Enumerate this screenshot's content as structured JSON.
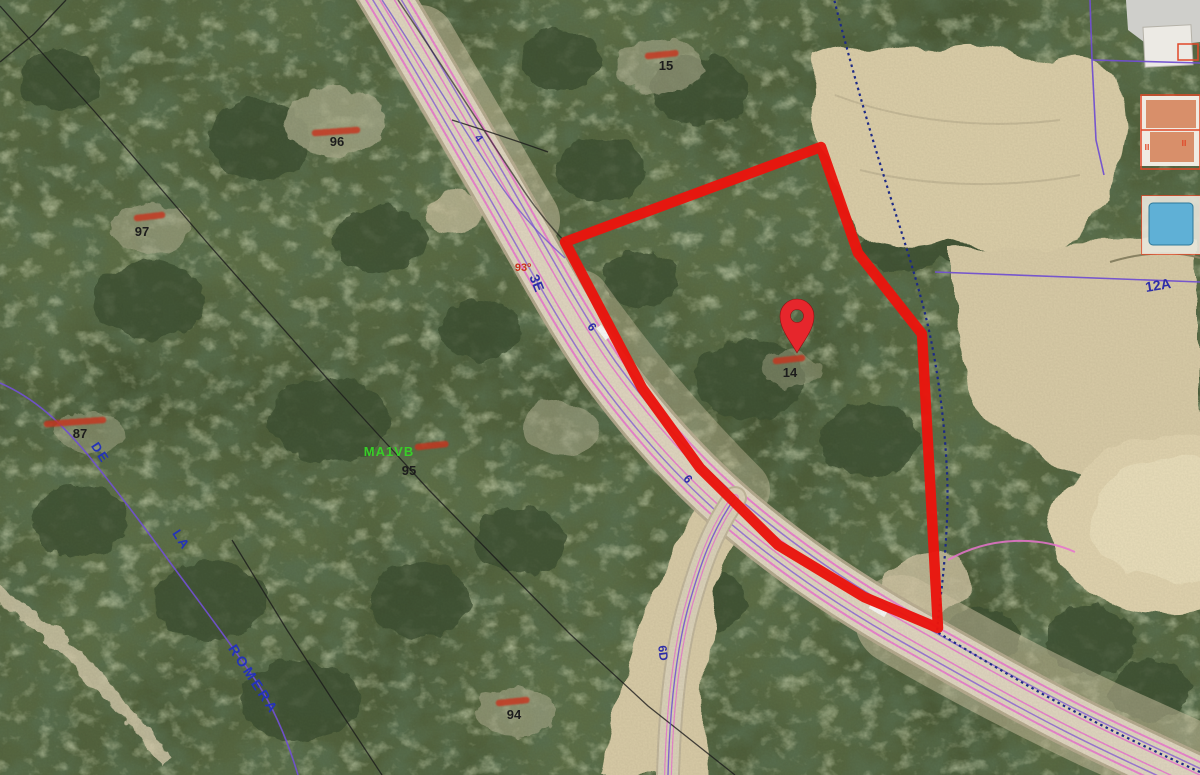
{
  "app": {
    "view_type": "aerial-cadastral-map"
  },
  "map": {
    "parcel_numbers": {
      "p96": "96",
      "p97": "97",
      "p95": "95",
      "p94": "94",
      "p15": "15",
      "p14": "14",
      "p87": "87"
    },
    "road_numbers": {
      "n4": "4",
      "n3e": "3E",
      "n6a": "6",
      "n6b": "6",
      "n6d": "6D",
      "n12a": "12A"
    },
    "red_survey_number": "93º",
    "street_name_parts": {
      "part1": "DE",
      "part2": "LA",
      "part3": "ROMERA"
    },
    "land_code_green": "MA1VB",
    "building_floor_marks": {
      "m1": "II",
      "m2": "II"
    },
    "colors": {
      "selection_outline": "#e9150d",
      "pin": "#e6262c",
      "cadastral_pink": "#e673cc",
      "cadastral_purple": "#7150cf",
      "cadastral_navy_dotted": "#1d2a85",
      "street_label_blue": "#2433b8",
      "road_number_blue": "#2d2da8",
      "parcel_label_black": "#1c1c1c",
      "land_code_green_color": "#38cf28",
      "red_annotation": "#c8311c",
      "building_outline_red": "#e04828"
    }
  }
}
